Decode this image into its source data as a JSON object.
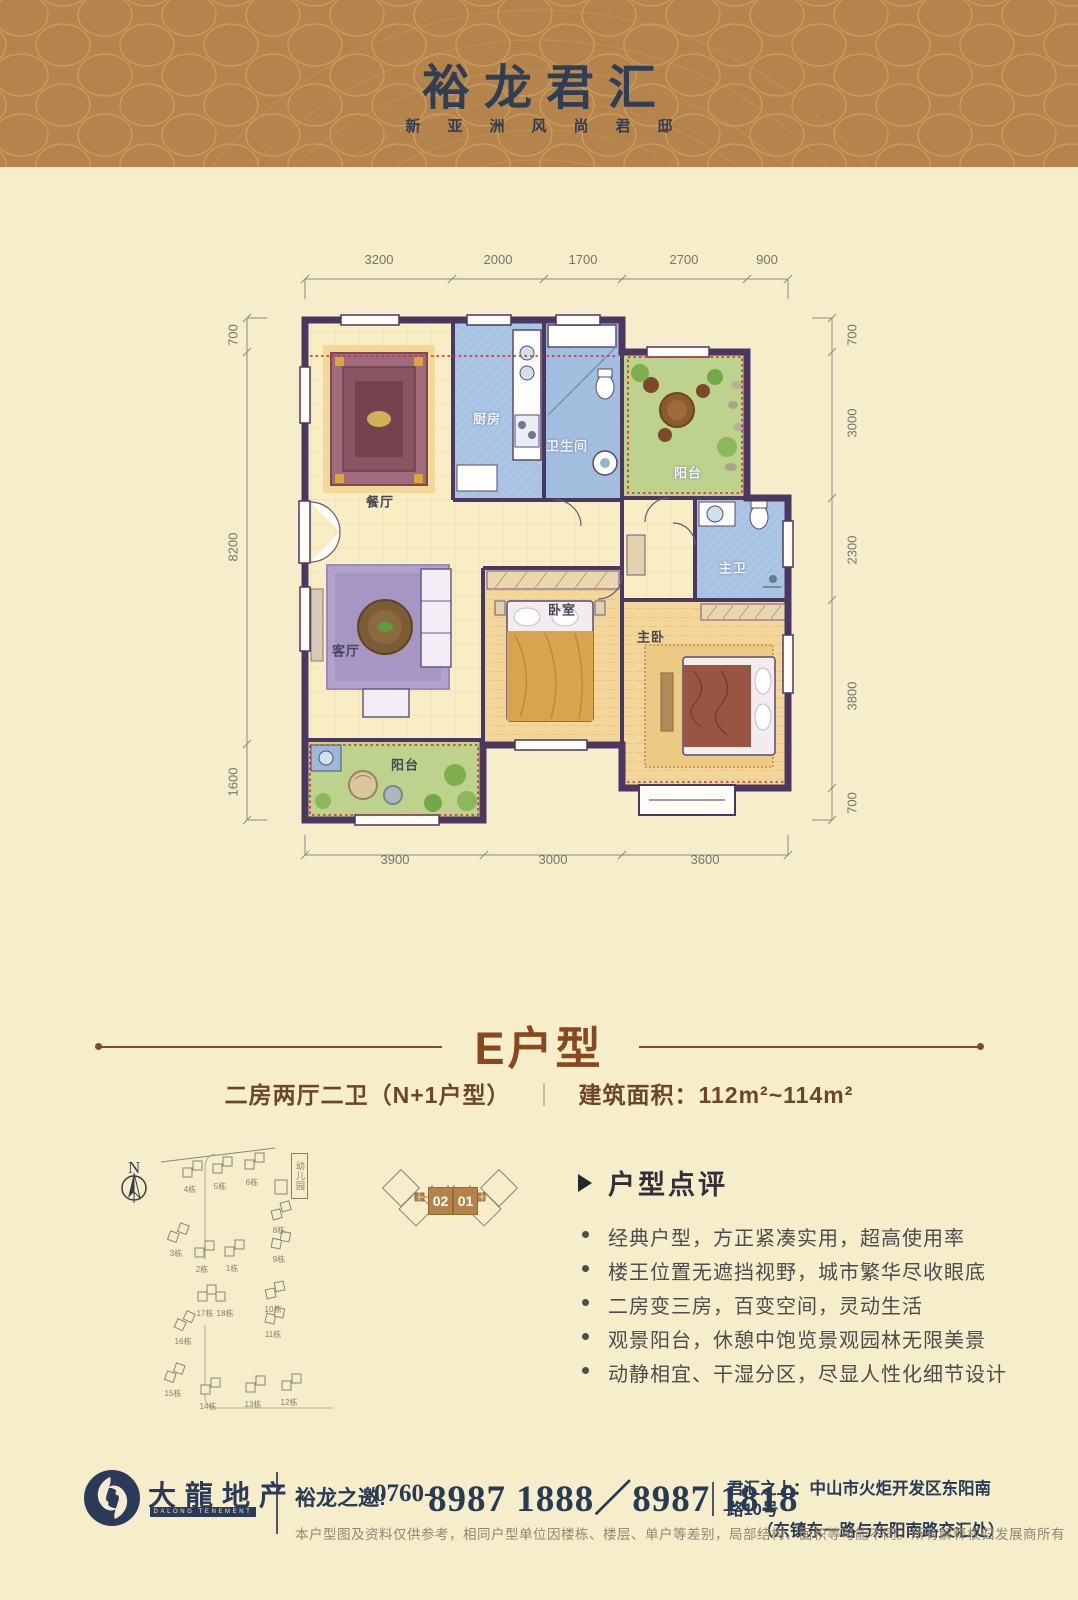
{
  "colors": {
    "header_bg": "#b5834c",
    "body_bg": "#f6edca",
    "navy": "#2b3a58",
    "title_brown": "#8a481e",
    "wall_purple": "#4a3862",
    "red_dotted": "#e02424"
  },
  "header": {
    "title": "裕龙君汇",
    "subtitle": "新亚洲风尚君邸"
  },
  "plan": {
    "dims": {
      "top": [
        "3200",
        "2000",
        "1700",
        "2700",
        "900"
      ],
      "bottom": [
        "3900",
        "3000",
        "3600"
      ],
      "left": [
        "700",
        "8200",
        "1600"
      ],
      "right": [
        "700",
        "3000",
        "2300",
        "3800",
        "700"
      ]
    },
    "rooms": [
      {
        "label": "餐厅"
      },
      {
        "label": "厨房"
      },
      {
        "label": "卫生间"
      },
      {
        "label": "阳台"
      },
      {
        "label": "主卫"
      },
      {
        "label": "客厅"
      },
      {
        "label": "卧室"
      },
      {
        "label": "主卧"
      },
      {
        "label": "阳台"
      }
    ]
  },
  "type_section": {
    "title": "E户型",
    "spec": "二房两厅二卫（N+1户型）",
    "divider": "｜",
    "area": "建筑面积：112m²~114m²"
  },
  "site_plan": {
    "north_label": "N",
    "kindergarten": "幼儿园",
    "buildings": [
      "4栋",
      "5栋",
      "6栋",
      "3栋",
      "2栋",
      "1栋",
      "8栋",
      "9栋",
      "17栋",
      "18栋",
      "16栋",
      "10栋",
      "11栋",
      "15栋",
      "14栋",
      "13栋",
      "12栋"
    ],
    "units": [
      "02",
      "01"
    ]
  },
  "comments": {
    "title": "户型点评",
    "items": [
      "经典户型，方正紧凑实用，超高使用率",
      "楼王位置无遮挡视野，城市繁华尽收眼底",
      "二房变三房，百变空间，灵动生活",
      "观景阳台，休憩中饱览景观园林无限美景",
      "动静相宜、干湿分区，尽显人性化细节设计"
    ]
  },
  "footer": {
    "brand": "大龍地产",
    "brand_en": "DALONG TENEMENT",
    "invite_label": "裕龙之邀:",
    "phone_prefix": "0760-",
    "phone_big": "8987 1888／8987 1818",
    "addr_label": "君汇之上：",
    "addr_line1": "中山市火炬开发区东阳南路10号",
    "addr_line2": "（东镇东一路与东阳南路交汇处）",
    "disclaimer": "本户型图及资料仅供参考，相同户型单位因楼栋、楼层、单户等差别，局部结构、面积等可能不同。所有解释权归发展商所有"
  }
}
